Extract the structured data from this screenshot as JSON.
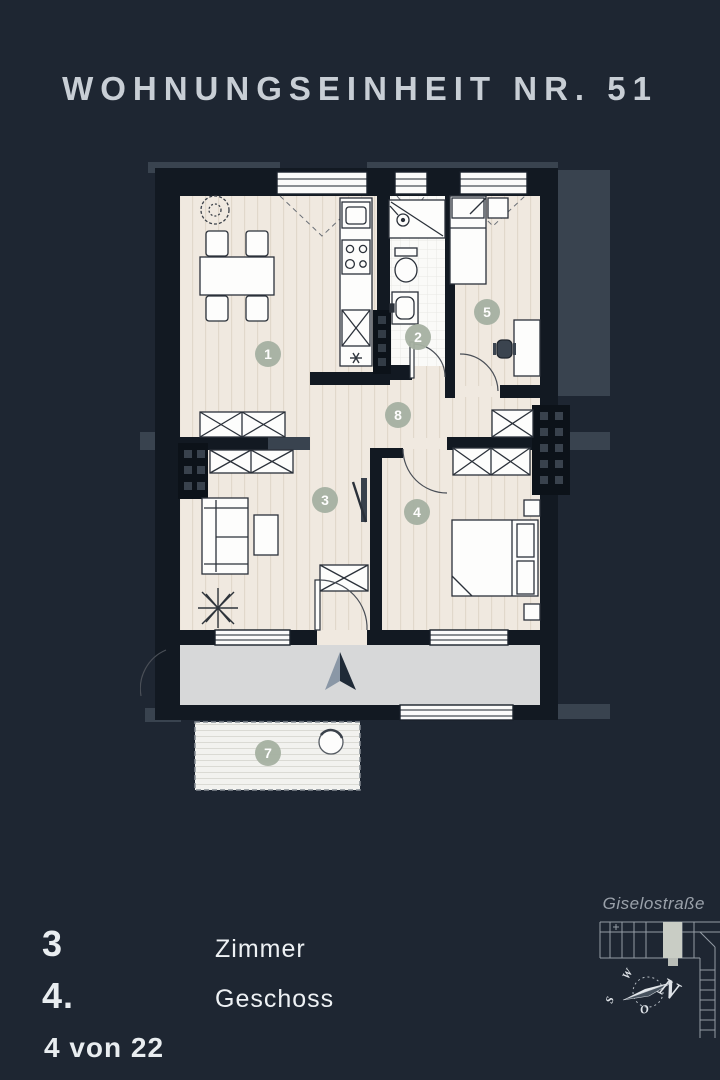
{
  "title": "WOHNUNGSEINHEIT NR. 51",
  "plan": {
    "room_labels": [
      "1",
      "2",
      "3",
      "4",
      "5",
      "7",
      "8"
    ]
  },
  "details": {
    "rows": [
      {
        "value": "3",
        "label": "Zimmer"
      },
      {
        "value": "4.",
        "label": "Geschoss"
      }
    ],
    "unit_position": "4 von 22"
  },
  "site": {
    "street": "Giselostraße",
    "compass": {
      "n": "N",
      "w": "W",
      "s": "S",
      "o": "O"
    }
  },
  "colors": {
    "background": "#1e2632",
    "wall_dark": "#121922",
    "wall_light": "#39434f",
    "floor": "#f0e9e0",
    "walkway": "#d7d8d9",
    "room_label_accent": "#a6b1a2",
    "title_text": "#c8ced5"
  }
}
